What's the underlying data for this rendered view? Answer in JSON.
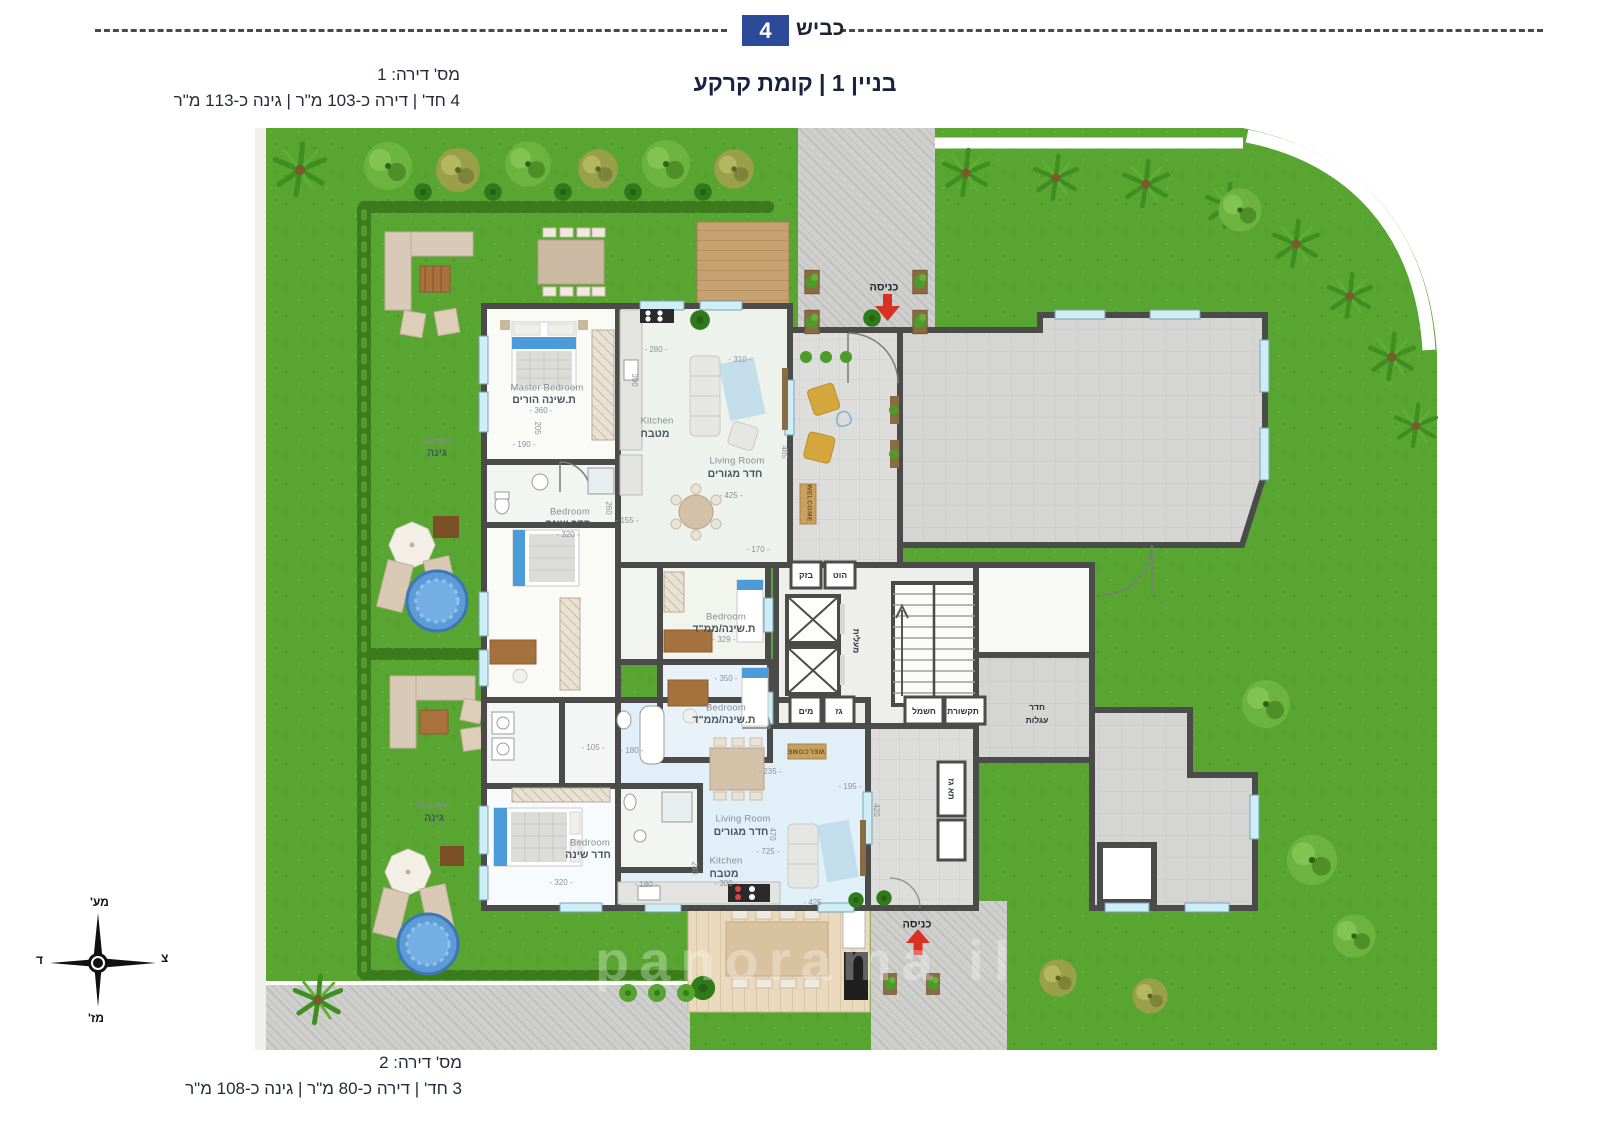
{
  "header": {
    "road_label": "כביש",
    "road_number": "4",
    "title": "בניין 1 | קומת קרקע"
  },
  "apartment1_info": {
    "line1": "מס' דירה: 1",
    "line2": "4 חד' | דירה כ-103 מ\"ר | גינה כ-113 מ\"ר"
  },
  "apartment2_info": {
    "line1": "מס' דירה: 2",
    "line2": "3 חד' | דירה כ-80 מ\"ר | גינה כ-108 מ\"ר"
  },
  "compass": {
    "top": "מע'",
    "right": "צ",
    "left": "ד",
    "bottom": "מז'"
  },
  "watermark": "panorama il",
  "colors": {
    "accent_blue": "#2b4a99",
    "title_navy": "#17223e",
    "wall": "#4b4b49",
    "grass": "#58a531",
    "entrance_arrow": "#d93025"
  },
  "plan": {
    "labels": [
      {
        "t": "Master Bedroom",
        "x": 547,
        "y": 388,
        "k": "en"
      },
      {
        "t": "ת.שינה הורים",
        "x": 544,
        "y": 400,
        "k": "he"
      },
      {
        "t": "- 360 -",
        "x": 541,
        "y": 411,
        "k": "dim"
      },
      {
        "t": "Kitchen",
        "x": 657,
        "y": 421,
        "k": "en"
      },
      {
        "t": "מטבח",
        "x": 655,
        "y": 434,
        "k": "he"
      },
      {
        "t": "Living Room",
        "x": 737,
        "y": 461,
        "k": "en"
      },
      {
        "t": "חדר מגורים",
        "x": 735,
        "y": 474,
        "k": "he"
      },
      {
        "t": "Bedroom",
        "x": 570,
        "y": 512,
        "k": "en"
      },
      {
        "t": "חדר שינה",
        "x": 568,
        "y": 524,
        "k": "he"
      },
      {
        "t": "- 320 -",
        "x": 568,
        "y": 535,
        "k": "dim"
      },
      {
        "t": "Bedroom",
        "x": 726,
        "y": 617,
        "k": "en"
      },
      {
        "t": "ת.שינה/ממ\"ד",
        "x": 724,
        "y": 629,
        "k": "he"
      },
      {
        "t": "- 329 -",
        "x": 724,
        "y": 640,
        "k": "dim"
      },
      {
        "t": "Bedroom",
        "x": 726,
        "y": 708,
        "k": "en"
      },
      {
        "t": "ת.שינה/ממ\"ד",
        "x": 724,
        "y": 720,
        "k": "he"
      },
      {
        "t": "Garden",
        "x": 437,
        "y": 441,
        "k": "en"
      },
      {
        "t": "גינה",
        "x": 437,
        "y": 453,
        "k": "he"
      },
      {
        "t": "Garden",
        "x": 434,
        "y": 806,
        "k": "en"
      },
      {
        "t": "גינה",
        "x": 434,
        "y": 818,
        "k": "he"
      },
      {
        "t": "Bedroom",
        "x": 590,
        "y": 843,
        "k": "en"
      },
      {
        "t": "חדר שינה",
        "x": 588,
        "y": 855,
        "k": "he"
      },
      {
        "t": "Living Room",
        "x": 743,
        "y": 819,
        "k": "en"
      },
      {
        "t": "חדר מגורים",
        "x": 741,
        "y": 832,
        "k": "he"
      },
      {
        "t": "Kitchen",
        "x": 726,
        "y": 861,
        "k": "en"
      },
      {
        "t": "מטבח",
        "x": 724,
        "y": 874,
        "k": "he"
      },
      {
        "t": "כניסה",
        "x": 884,
        "y": 288,
        "k": "ent"
      },
      {
        "t": "כניסה",
        "x": 917,
        "y": 925,
        "k": "ent"
      },
      {
        "t": "בזק",
        "x": 806,
        "y": 575,
        "k": "util"
      },
      {
        "t": "הוט",
        "x": 840,
        "y": 575,
        "k": "util"
      },
      {
        "t": "מים",
        "x": 806,
        "y": 711,
        "k": "util"
      },
      {
        "t": "גז",
        "x": 839,
        "y": 711,
        "k": "util"
      },
      {
        "t": "חשמל",
        "x": 924,
        "y": 711,
        "k": "util"
      },
      {
        "t": "תקשורת",
        "x": 963,
        "y": 711,
        "k": "util"
      },
      {
        "t": "מעלית",
        "x": 856,
        "y": 641,
        "k": "util",
        "r": 90
      },
      {
        "t": "חדר",
        "x": 1037,
        "y": 707,
        "k": "util"
      },
      {
        "t": "עגלות",
        "x": 1037,
        "y": 720,
        "k": "util"
      },
      {
        "t": "תא גז",
        "x": 951,
        "y": 789,
        "k": "util",
        "r": 90
      },
      {
        "t": "WELCOME",
        "x": 808,
        "y": 503,
        "k": "wel",
        "r": 90
      },
      {
        "t": "WELCOME",
        "x": 806,
        "y": 750,
        "k": "wel",
        "r": 180
      },
      {
        "t": "- 280 -",
        "x": 656,
        "y": 350,
        "k": "dim"
      },
      {
        "t": "390",
        "x": 634,
        "y": 380,
        "k": "dim",
        "r": 90
      },
      {
        "t": "- 310 -",
        "x": 740,
        "y": 360,
        "k": "dim"
      },
      {
        "t": "485",
        "x": 784,
        "y": 452,
        "k": "dim",
        "r": 90
      },
      {
        "t": "- 425 -",
        "x": 731,
        "y": 496,
        "k": "dim"
      },
      {
        "t": "- 190 -",
        "x": 524,
        "y": 445,
        "k": "dim"
      },
      {
        "t": "205",
        "x": 537,
        "y": 428,
        "k": "dim",
        "r": 90
      },
      {
        "t": "- 155 -",
        "x": 627,
        "y": 521,
        "k": "dim"
      },
      {
        "t": "260",
        "x": 608,
        "y": 508,
        "k": "dim",
        "r": 90
      },
      {
        "t": "- 170 -",
        "x": 758,
        "y": 550,
        "k": "dim"
      },
      {
        "t": "- 350 -",
        "x": 726,
        "y": 679,
        "k": "dim"
      },
      {
        "t": "- 105 -",
        "x": 593,
        "y": 748,
        "k": "dim"
      },
      {
        "t": "- 180 -",
        "x": 632,
        "y": 751,
        "k": "dim"
      },
      {
        "t": "- 235 -",
        "x": 770,
        "y": 772,
        "k": "dim"
      },
      {
        "t": "- 195 -",
        "x": 850,
        "y": 787,
        "k": "dim"
      },
      {
        "t": "470",
        "x": 772,
        "y": 834,
        "k": "dim",
        "r": 90
      },
      {
        "t": "- 725 -",
        "x": 768,
        "y": 852,
        "k": "dim"
      },
      {
        "t": "420",
        "x": 876,
        "y": 810,
        "k": "dim",
        "r": 90
      },
      {
        "t": "- 300 -",
        "x": 726,
        "y": 884,
        "k": "dim"
      },
      {
        "t": "240",
        "x": 694,
        "y": 868,
        "k": "dim",
        "r": 90
      },
      {
        "t": "- 320 -",
        "x": 561,
        "y": 883,
        "k": "dim"
      },
      {
        "t": "- 180 -",
        "x": 646,
        "y": 885,
        "k": "dim"
      },
      {
        "t": "- 425 -",
        "x": 815,
        "y": 903,
        "k": "dim"
      }
    ]
  }
}
